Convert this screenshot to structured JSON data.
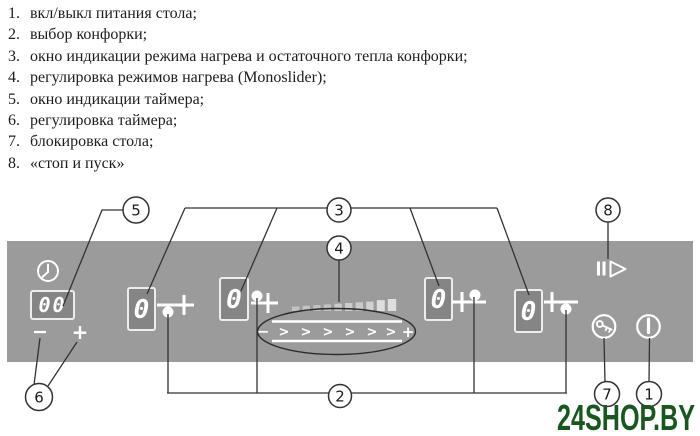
{
  "legend": {
    "items": [
      {
        "num": "1.",
        "text": "вкл/выкл питания стола;"
      },
      {
        "num": "2.",
        "text": "выбор конфорки;"
      },
      {
        "num": "3.",
        "text": "окно индикации режима нагрева и остаточного тепла конфорки;"
      },
      {
        "num": "4.",
        "text": "регулировка режимов нагрева (Monoslider);"
      },
      {
        "num": "5.",
        "text": "окно индикации таймера;"
      },
      {
        "num": "6.",
        "text": "регулировка таймера;"
      },
      {
        "num": "7.",
        "text": "блокировка стола;"
      },
      {
        "num": "8.",
        "text": "«стоп и пуск»"
      }
    ]
  },
  "panel": {
    "bg_color": "#9b9b9b",
    "timer": {
      "display": "00",
      "minus": "−",
      "plus": "+"
    },
    "burners": [
      {
        "value": "0"
      },
      {
        "value": "0"
      },
      {
        "value": "0"
      },
      {
        "value": "0"
      }
    ],
    "slider": {
      "minus": "−",
      "plus": "+",
      "chevron": ">"
    },
    "icons": [
      "clock-icon",
      "burner-select-icon",
      "power-level-bars",
      "stop-and-go-icon",
      "key-lock-icon",
      "power-icon"
    ]
  },
  "callouts": {
    "n1": "1",
    "n2": "2",
    "n3": "3",
    "n4": "4",
    "n5": "5",
    "n6": "6",
    "n7": "7",
    "n8": "8"
  },
  "watermark": {
    "text": "24SHOP.BY",
    "color": "#17591d"
  }
}
